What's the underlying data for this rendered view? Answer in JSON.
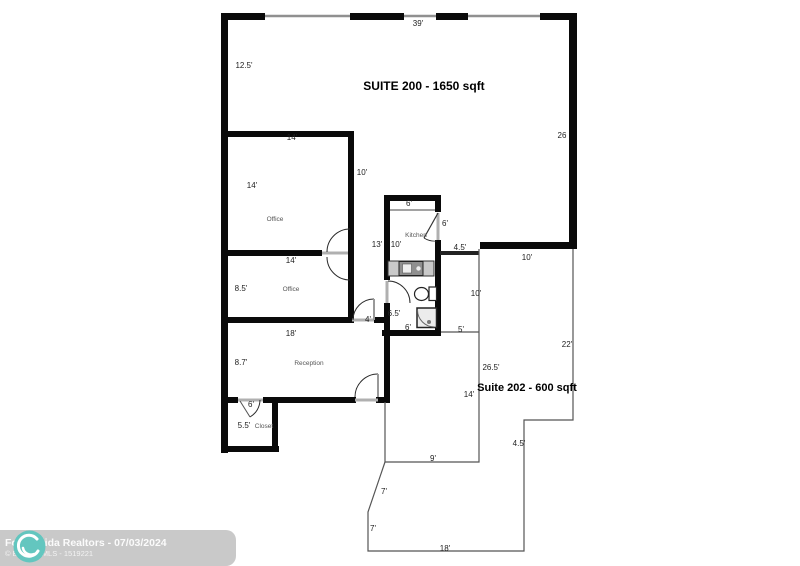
{
  "plan": {
    "suite200_title": "SUITE 200 - 1650 sqft",
    "suite202_title": "Suite 202 - 600 sqft"
  },
  "rooms": {
    "office1": "Office",
    "office2": "Office",
    "kitchen": "Kitchen",
    "reception": "Reception",
    "closet": "Closet"
  },
  "dims": {
    "top_39": "39'",
    "left_12_5": "12.5'",
    "right_26": "26",
    "o1_top_14": "14'",
    "o1_left_14": "14'",
    "o1_right_10": "10'",
    "k_top_6": "6'",
    "k_door_6": "6'",
    "hall_13": "13'",
    "k_10": "10'",
    "gap_4_5": "4.5'",
    "tr_10": "10'",
    "o2_top_14": "14'",
    "o2_left_8_5": "8.5'",
    "bath_r_10": "10'",
    "bath_l_6_5": "6.5'",
    "hall_door_4": "4'",
    "bath_b_6": "6'",
    "corr_5": "5'",
    "rec_18": "18'",
    "s202_22": "22'",
    "rec_8_7": "8.7'",
    "s202_26_5": "26.5'",
    "s202_14": "14'",
    "closet_door_6": "6'",
    "closet_5_5": "5.5'",
    "s202_4_5": "4.5'",
    "s202_9": "9'",
    "s202_7a": "7'",
    "s202_7b": "7'",
    "s202_18": "18'"
  },
  "banner": {
    "line1": "For Florida Realtors - 07/03/2024",
    "line2": "© BeachesMLS - 1519221"
  },
  "colors": {
    "wall": "#0a0a0a",
    "thin_line": "#555555",
    "window_line": "#909090",
    "threshold": "#b0b0b0",
    "banner_bg": "#c9c9c9",
    "logo_teal": "#63c6bf",
    "banner_text": "#ffffff"
  }
}
